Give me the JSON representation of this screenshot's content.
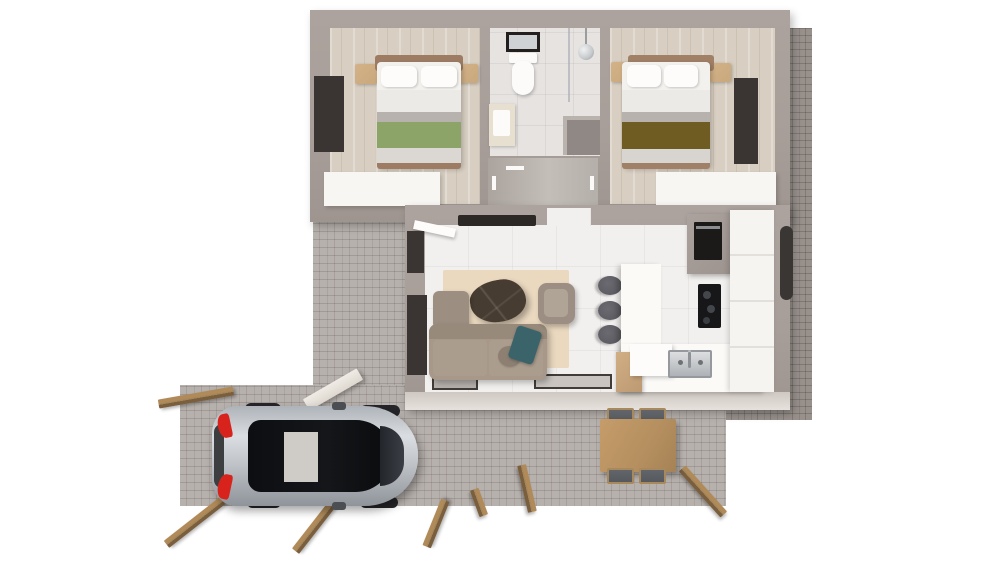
{
  "scene": {
    "title": "3D floor plan render",
    "description": "Top-down 3D architectural rendering of a small single-storey house with two bedrooms, a central bathroom and hallway, an open-plan living room and kitchen, a brick-paved driveway with a parked silver car, a patio with an outdoor dining set, and scattered wooden planks around the paving."
  },
  "colors": {
    "background": "#ffffff",
    "wall": "#a89e99",
    "woodFloor": "#d8cfc2",
    "bathTile": "#e6e3e1",
    "livingTile": "#f2f0ee",
    "hallFloor": "#c4beb9",
    "pavingLight": "#b7b1ad",
    "pavingDark": "#97908b",
    "whiteFurniture": "#f8f6f3",
    "rug": "#ead8bf",
    "sofa": "#a79889",
    "armchair": "#9c8e82",
    "tealPillow": "#3a646a",
    "coffeeTable": "#473c31",
    "nightstandWood": "#c8a87c",
    "headboard": "#9d7c63",
    "greenThrow": "#8ca467",
    "oliveThrow": "#6e5c22",
    "duvet": "#eceae6",
    "stool": "#55555b",
    "diningWood": "#b58f5f",
    "chairSeat": "#55595d",
    "plankTop": "#a5855a",
    "plankSide": "#7a5f3e",
    "carBody": "#c3c7cc",
    "carGlass": "#141619",
    "tailLight": "#d8231c",
    "chrome": "#c6c9cc",
    "applianceDark": "#1b1a19",
    "ovenTower": "#9d948f"
  },
  "rooms": [
    {
      "id": "bedroom-left",
      "label": "Left bedroom",
      "furniture": [
        "double bed with green throw",
        "two wooden nightstands",
        "white wardrobe",
        "dark-framed window"
      ]
    },
    {
      "id": "bathroom",
      "label": "Bathroom",
      "furniture": [
        "toilet",
        "black-framed mirror",
        "vanity with sink",
        "shower with round head and glass partition",
        "storage niche"
      ]
    },
    {
      "id": "hallway",
      "label": "Hallway",
      "furniture": [
        "doorways with handles"
      ]
    },
    {
      "id": "bedroom-right",
      "label": "Right bedroom",
      "furniture": [
        "double bed with olive throw",
        "two wooden nightstands",
        "white wardrobe",
        "dark-framed window"
      ]
    },
    {
      "id": "living-room",
      "label": "Living room",
      "furniture": [
        "taupe sofa",
        "chaise seat",
        "armchair",
        "teal pillow",
        "round cushion",
        "organic dark-wood coffee table",
        "cream rug",
        "wall-mounted TV",
        "open front door",
        "two dark-framed windows",
        "two low windows in south wall"
      ]
    },
    {
      "id": "kitchen",
      "label": "Kitchen",
      "furniture": [
        "L-shaped white counter",
        "island with wood front",
        "three dark bar stools",
        "oven tower",
        "black cooktop",
        "stainless sink with faucet",
        "tall white cabinets"
      ]
    }
  ],
  "exterior": {
    "driveway": {
      "label": "Brick-paved driveway",
      "items": [
        "silver hatchback car with red taillights and black roof"
      ]
    },
    "patio": {
      "label": "Brick-paved patio",
      "items": [
        "wooden dining table",
        "four chairs with dark seats"
      ]
    },
    "right_strip": {
      "label": "Dark brick paving strip along right wall",
      "items": [
        "dark wall-mounted exterior unit"
      ]
    },
    "misc": [
      "scattered wooden planks",
      "white beam on driveway"
    ]
  }
}
